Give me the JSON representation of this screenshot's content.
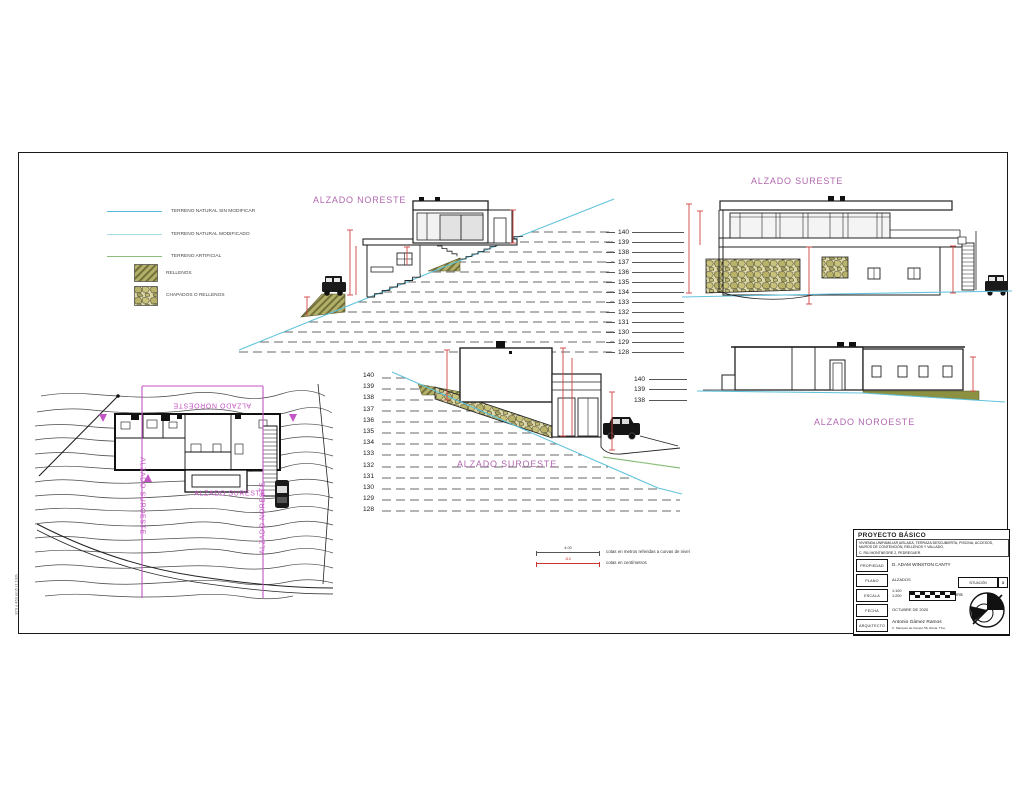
{
  "sheet": {
    "frame_note": "870 x 463 pm5 (1:100)"
  },
  "colors": {
    "title_magenta": "#b168b0",
    "section_magenta": "#c455c4",
    "dim_red": "#d04343",
    "terrain_cyan": "#62c3dc",
    "terrain_cyan_light": "#a8dde9",
    "terrain_green": "#8cbe7c"
  },
  "legend": {
    "terrain_lines": [
      {
        "label": "TERRENO NATURAL SIN MODIFICAR",
        "color": "#55b9d9"
      },
      {
        "label": "TERRENO NATURAL MODIFICADO",
        "color": "#a8dde9"
      },
      {
        "label": "TERRENO ARTIFICIAL",
        "color": "#8cbe7c"
      }
    ],
    "fill_swatches": [
      {
        "label": "RELLENOS",
        "type": "hatch"
      },
      {
        "label": "CHAPADOS O RELLENOS",
        "type": "stone"
      }
    ]
  },
  "elevation_titles": {
    "noreste": "ALZADO NORESTE",
    "sureste": "ALZADO SURESTE",
    "suroeste": "ALZADO SUROESTE",
    "noroeste": "ALZADO NOROESTE"
  },
  "levels": {
    "noreste": [
      "140",
      "139",
      "138",
      "137",
      "136",
      "135",
      "134",
      "133",
      "132",
      "131",
      "130",
      "129",
      "128"
    ],
    "suroeste": [
      "140",
      "139",
      "138",
      "137",
      "136",
      "135",
      "134",
      "133",
      "132",
      "131",
      "130",
      "129",
      "128"
    ],
    "noroeste_partial": [
      "140",
      "139",
      "138"
    ]
  },
  "site_plan_labels": {
    "top": "ALZADO NOROESTE",
    "left": "ALZADO SUROESTE",
    "right": "ALZADO NORESTE",
    "bottom": "ALZADO SURESTE"
  },
  "dim_legend": {
    "meters_value": "4.00",
    "meters_text": "cotas en metros referidas a curvas de nivel",
    "cm_value": "110",
    "cm_text": "cotas en centímetros"
  },
  "title_block": {
    "project": "PROYECTO BÁSICO",
    "description": "VIVIENDA UNIFAMILIAR AISLADA, TERRAZA DESCUBIERTA, PISCINA, ACCESOS, MUROS DE CONTENCIÓN, RELLENOS Y VALLADO.",
    "address": "C. RIU MONTNEGRE 2, PEDREGUER.",
    "propiedad_label": "PROPIEDAD",
    "propiedad": "D. ADAM WINSTON CANTY",
    "plano_label": "PLANO",
    "plano": "ALZADOS",
    "escala_label": "ESCALA",
    "escala1": "1:100",
    "escala2": "1:200",
    "escala_unit": "mts",
    "fecha_label": "FECHA",
    "fecha": "OCTUBRE DE 2020",
    "arquitecto_label": "ARQUITECTO",
    "arquitecto": "Antonio Gámez Ramos",
    "arquitecto_detail": "C. Marqués de Campo 58, Dénia. Tfno.",
    "situacion": "SITUACIÓN",
    "situacion_letter": "a"
  }
}
